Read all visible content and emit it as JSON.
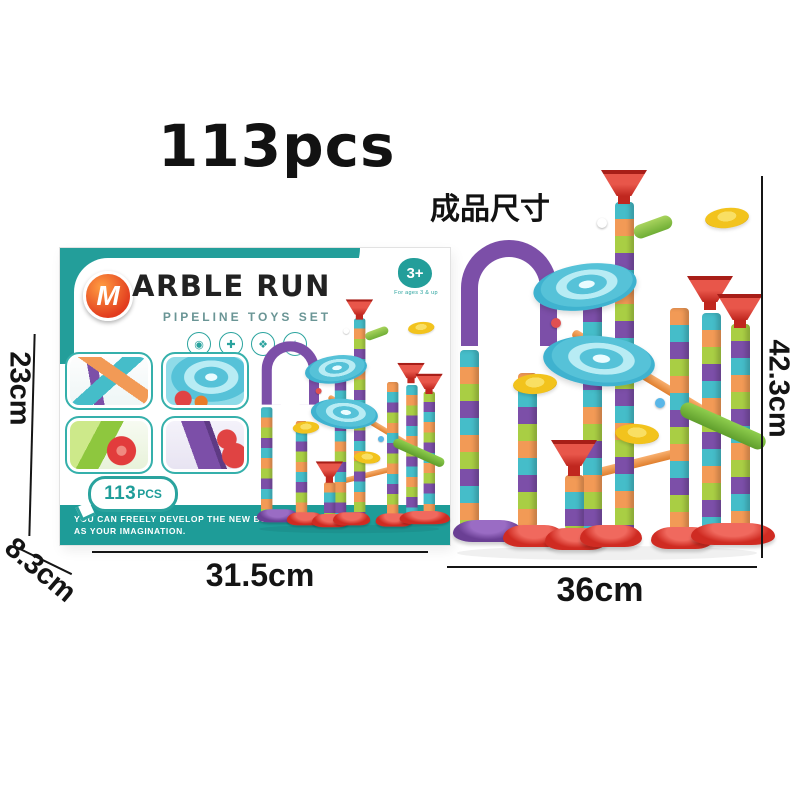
{
  "page": {
    "pieces_label": "113pcs",
    "size_label_cn": "成品尺寸"
  },
  "box": {
    "brand_initial": "M",
    "brand_rest": "ARBLE RUN",
    "subtitle": "PIPELINE TOYS SET",
    "age_badge": "3+",
    "age_caption": "For ages 3 & up",
    "pcs_number": "113",
    "pcs_unit": "PCS",
    "slogan_line1": "YOU CAN FREELY DEVELOP THE NEW BUILDING",
    "slogan_line2": "AS YOUR IMAGINATION.",
    "feature_icons": [
      {
        "name": "vision-icon",
        "glyph": "◉"
      },
      {
        "name": "hands-on-icon",
        "glyph": "✚"
      },
      {
        "name": "creativity-icon",
        "glyph": "❖"
      },
      {
        "name": "fun-icon",
        "glyph": "☆"
      }
    ]
  },
  "dimensions": {
    "box_height": "23cm",
    "box_depth": "8.3cm",
    "box_width": "31.5cm",
    "assembled_height": "42.3cm",
    "assembled_width": "36cm"
  },
  "colors": {
    "teal": "#1E9C98",
    "red": "#CF2B22",
    "orange": "#F29A56",
    "green": "#A9CE44",
    "purple": "#7C4FA8",
    "blue": "#53BFD6",
    "yellow": "#F2C31D"
  }
}
